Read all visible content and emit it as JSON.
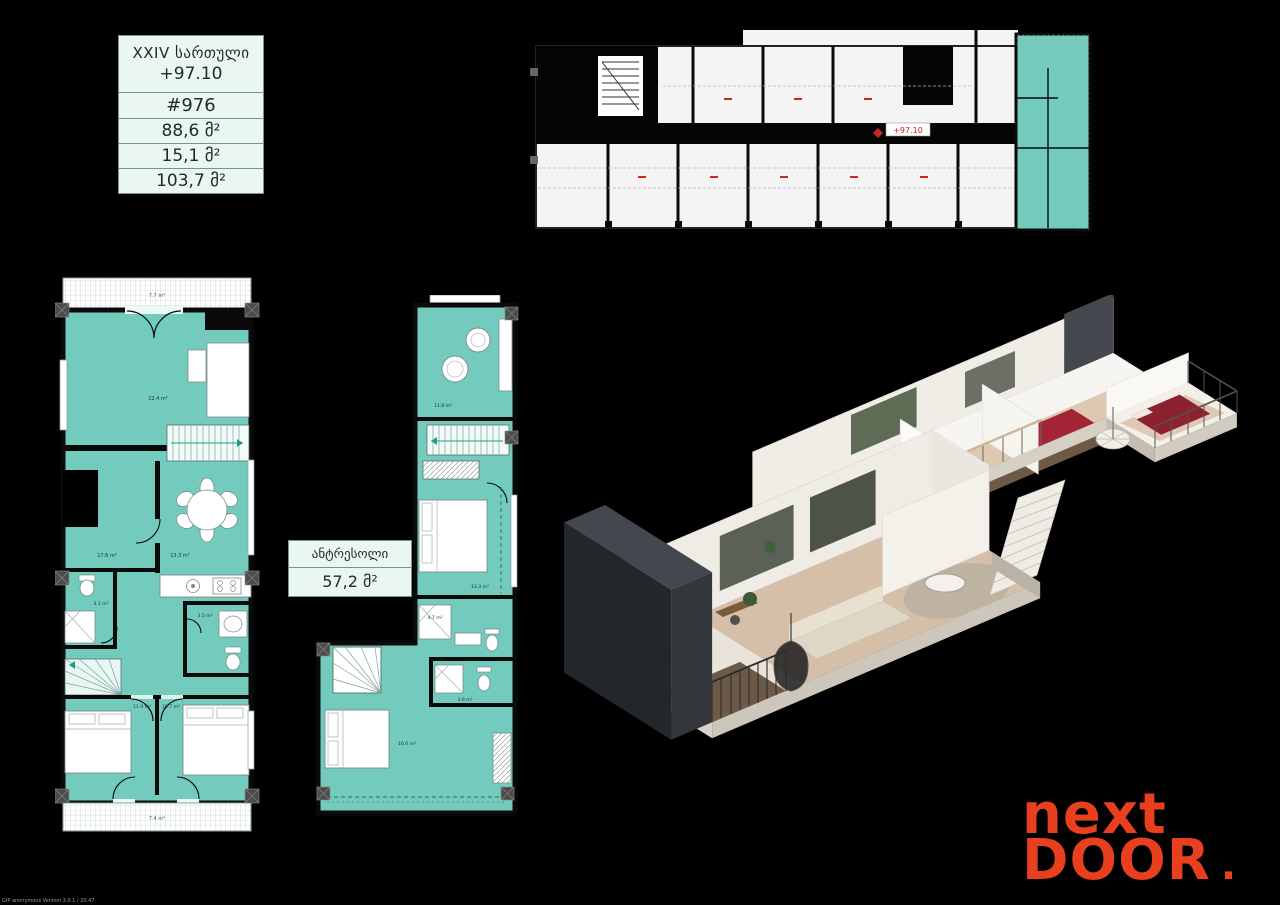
{
  "info_table": {
    "floor_label": "XXIV სართული",
    "elevation": "+97.10",
    "unit_number": "#976",
    "net_area": "88,6 მ²",
    "balcony_area": "15,1 მ²",
    "total_area": "103,7 მ²"
  },
  "mezzanine_table": {
    "title": "ანტრესოლი",
    "area": "57,2 მ²"
  },
  "overview_plan": {
    "marker_label": "+97.10"
  },
  "main_plan": {
    "rooms": {
      "terrace_top": "7.7 m²",
      "living": "22.4 m²",
      "hall": "17.6 m²",
      "dining": "13.3 m²",
      "bathroom": "3.1 m²",
      "wc": "3.5 m²",
      "bedroom_left": "11.0 m²",
      "bedroom_right": "10.7 m²",
      "balcony_bottom": "7.4 m²"
    }
  },
  "mezzanine_plan": {
    "rooms": {
      "lounge": "11.8 m²",
      "bedroom": "13.3 m²",
      "bathroom": "4.7 m²",
      "bedroom_lower": "16.0 m²",
      "shower_room": "3.9 m²"
    }
  },
  "logo": {
    "line1": "next",
    "line2": "DOOR",
    "dot": "."
  },
  "watermark": "GIP anonymous Version 3.0.1 / 20.47",
  "colors": {
    "highlight_teal": "#72cbbc",
    "logo_orange": "#e8401f",
    "marker_red": "#c8281e",
    "table_bg": "#e9f6f2"
  }
}
